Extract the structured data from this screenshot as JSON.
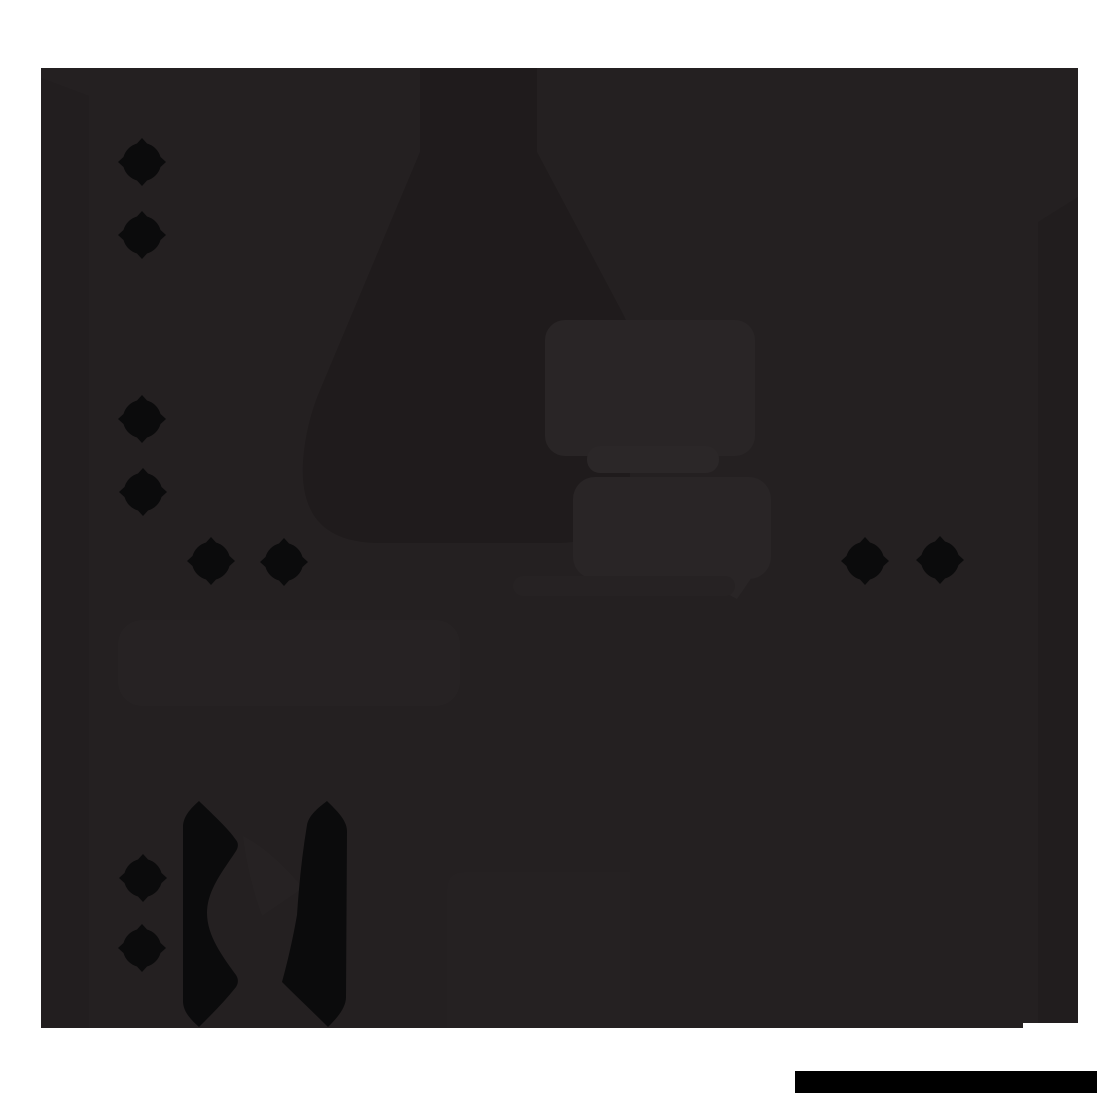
{
  "scene": {
    "description": "Near-black silhouetted illustration on a white page: dark artwork panel with faint flask and caption-box shapes, ten black sparkle diamonds, two serrated blade silhouettes at lower left, and a solid black redaction bar at bottom right",
    "canvas": {
      "width": 1100,
      "height": 1100
    },
    "palette": {
      "white": "#ffffff",
      "base": "#242021",
      "shadow": "#1f1b1c",
      "column": "#211d1e",
      "left_band": "#221e1f",
      "highlight": "#292526",
      "highlight_bright": "#2b2728",
      "soft": "#262223",
      "soft2": "#252122",
      "ink": "#0b0b0c",
      "bar": "#000000"
    },
    "shapes": [
      {
        "name": "artwork-panel",
        "type": "rect",
        "color": "base",
        "x": 41,
        "y": 68,
        "w": 1037,
        "h": 960,
        "rx": 0
      },
      {
        "name": "left-shade-band",
        "type": "path",
        "color": "left_band",
        "d": "M41 78 L89 96 L89 1028 L41 1028 Z"
      },
      {
        "name": "right-shade-column",
        "type": "path",
        "color": "column",
        "d": "M1038 222 L1078 197 L1078 1023 L1038 1023 Z"
      },
      {
        "name": "flask-silhouette",
        "type": "path",
        "color": "shadow",
        "d": "M420 68 L537 68 L537 152 L622 312 C633 333 636 352 630 366 L630 470 C630 519 605 543 556 543 L380 543 C325 543 300 516 303 462 C305 436 310 416 318 395 L420 152 Z"
      },
      {
        "name": "caption-box-lower-left",
        "type": "rect",
        "color": "soft",
        "x": 118,
        "y": 620,
        "w": 342,
        "h": 86,
        "rx": 24
      },
      {
        "name": "caption-box-main",
        "type": "rect",
        "color": "highlight",
        "x": 545,
        "y": 320,
        "w": 210,
        "h": 136,
        "rx": 20
      },
      {
        "name": "caption-band-bright",
        "type": "rect",
        "color": "highlight_bright",
        "x": 587,
        "y": 446,
        "w": 132,
        "h": 27,
        "rx": 13
      },
      {
        "name": "caption-box-second",
        "type": "rect",
        "color": "highlight",
        "x": 573,
        "y": 477,
        "w": 198,
        "h": 102,
        "rx": 22
      },
      {
        "name": "caption-box-tail",
        "type": "path",
        "color": "highlight",
        "d": "M695 577 L752 577 L737 599 Z"
      },
      {
        "name": "caption-band-soft",
        "type": "rect",
        "color": "soft",
        "x": 513,
        "y": 576,
        "w": 222,
        "h": 20,
        "rx": 10
      },
      {
        "name": "gap-wedge-highlight",
        "type": "path",
        "color": "soft",
        "d": "M243 836 C262 845 285 866 303 888 L262 916 C252 888 246 862 243 836 Z"
      },
      {
        "name": "bottom-middle-panel",
        "type": "path",
        "color": "soft2",
        "d": "M465 872 L630 872 L630 1028 L447 1028 L447 890 Q447 872 465 872 Z"
      },
      {
        "name": "left-serrated-blade",
        "type": "path",
        "color": "ink",
        "d": "M199 801 C209 811 228 828 236 840 C238.5 843 238.5 847 236 851 C223 871 207 890 207 913 C207 936 223 957 236 975 C238.5 979 238.5 983 236 987 C225 1001 210 1016 199 1027 C190 1019 183 1011 183 1001 L183 827 C183 817 190 809 199 801 Z"
      },
      {
        "name": "right-serrated-blade",
        "type": "path",
        "color": "ink",
        "d": "M327 801 C318 808 309 815 307 825 C302 855 299 885 297 915 C293 938 288 960 282 982 C297 997 313 1012 328 1027 C337 1018 346 1008 346 997 L347 831 C347 820 336 810 327 801 Z"
      },
      {
        "name": "panel-bottom-step",
        "type": "rect",
        "color": "white",
        "x": 1023,
        "y": 1023,
        "w": 57,
        "h": 6,
        "rx": 0
      },
      {
        "name": "redaction-bar",
        "type": "rect",
        "color": "bar",
        "x": 795,
        "y": 1071,
        "w": 302,
        "h": 22,
        "rx": 0
      }
    ],
    "sparkles": {
      "color": "ink",
      "tip_radius": 24,
      "body_radius": 19.5,
      "path": "M0 -24 L5 -18.5 A19.5 19.5 0 0 1 18.5 -5 L24 0 L18.5 5 A19.5 19.5 0 0 1 5 18.5 L0 24 L-5 18.5 A19.5 19.5 0 0 1 -18.5 5 L-24 0 L-18.5 -5 A19.5 19.5 0 0 1 -5 -18.5 Z",
      "positions": [
        {
          "cx": 142,
          "cy": 162
        },
        {
          "cx": 142,
          "cy": 235
        },
        {
          "cx": 142,
          "cy": 419
        },
        {
          "cx": 143,
          "cy": 492
        },
        {
          "cx": 211,
          "cy": 561
        },
        {
          "cx": 284,
          "cy": 562
        },
        {
          "cx": 865,
          "cy": 561
        },
        {
          "cx": 940,
          "cy": 560
        },
        {
          "cx": 143,
          "cy": 878
        },
        {
          "cx": 142,
          "cy": 948
        }
      ]
    }
  }
}
